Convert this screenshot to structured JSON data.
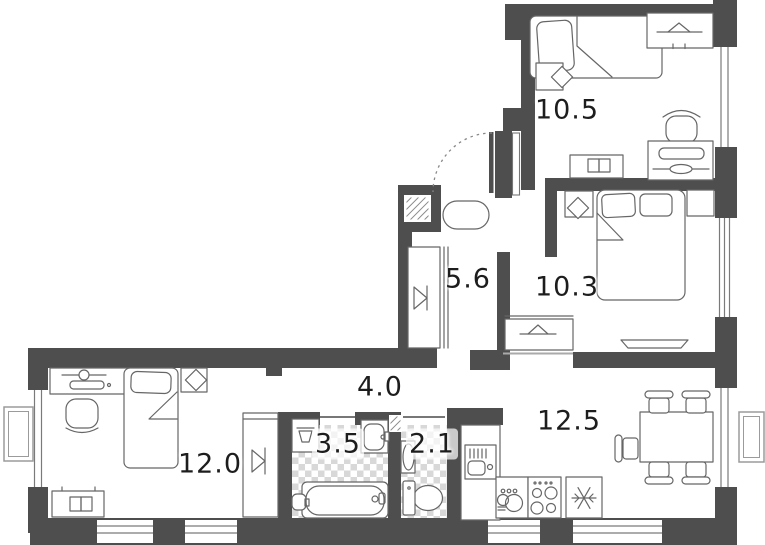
{
  "rooms": {
    "bedroom_top": {
      "label": "10.5"
    },
    "bedroom_right": {
      "label": "10.3"
    },
    "hallway": {
      "label": "5.6"
    },
    "corridor": {
      "label": "4.0"
    },
    "living_kitchen": {
      "label": "12.5"
    },
    "bedroom_left": {
      "label": "12.0"
    },
    "bathroom": {
      "label": "3.5"
    },
    "wc": {
      "label": "2.1"
    }
  },
  "colors": {
    "wall": "#4e4e4e",
    "furniture_line": "#666666",
    "tile": "#cbcbcb",
    "label_text": "#1d1d1d",
    "background": "#ffffff"
  },
  "icons": [
    "single-bed-icon",
    "double-bed-icon",
    "wardrobe-hanger-icon",
    "nightstand-lamp-icon",
    "desk-chair-icon",
    "dressing-table-icon",
    "dresser-icon",
    "closet-mirror-icon",
    "pouf-icon",
    "entry-door-icon",
    "vent-shaft-icon",
    "washing-machine-icon",
    "sink-icon",
    "bathtub-icon",
    "toilet-icon",
    "kitchen-sink-icon",
    "stove-icon",
    "fridge-snowflake-icon",
    "dish-cabinet-icon",
    "dining-table-icon",
    "chair-icon",
    "window-icon",
    "balcony-icon",
    "tv-icon"
  ]
}
